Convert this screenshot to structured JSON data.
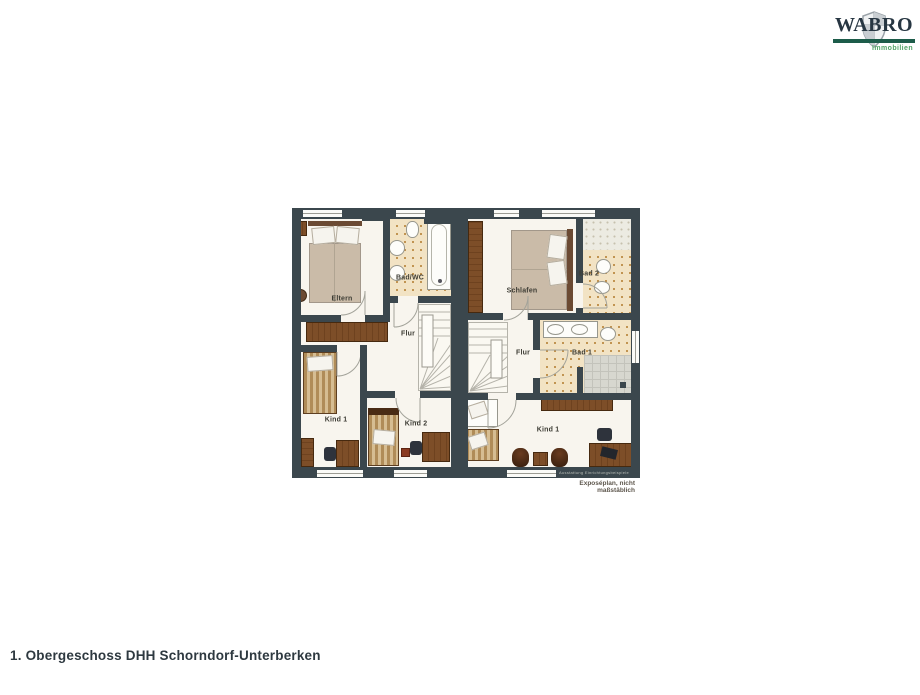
{
  "page": {
    "caption": "1. Obergeschoss DHH Schorndorf-Unterberken",
    "background": "#ffffff"
  },
  "logo": {
    "brand": "WABRO",
    "tagline": "Immobilien",
    "brand_color": "#273642",
    "bar_color": "#1d5c4a",
    "tagline_color": "#54a468"
  },
  "plan": {
    "type": "floorplan",
    "floor_name": "1. Obergeschoss",
    "building": "DHH Schorndorf-Unterberken",
    "disclaimer": "Exposéplan, nicht maßstäblich",
    "watermark": "Ausstattung Einrichtungsbeispiele",
    "colors": {
      "wall": "#3b474d",
      "floor": "#f8f5ee",
      "bath_tile": "#f2e3c4",
      "tile_dots": "#b9873f",
      "wood_furniture": "#7d4e28",
      "shower_tile": "#d7d7cf",
      "mattress": "#cabba8"
    },
    "left_unit": {
      "bedroom": "Eltern",
      "bath": "Bad/WC",
      "hall": "Flur",
      "child1": "Kind 1",
      "child2": "Kind 2"
    },
    "right_unit": {
      "bedroom": "Schlafen",
      "bath_upper": "Bad 2",
      "hall": "Flur",
      "bath_lower": "Bad 1",
      "child1": "Kind 1"
    }
  }
}
